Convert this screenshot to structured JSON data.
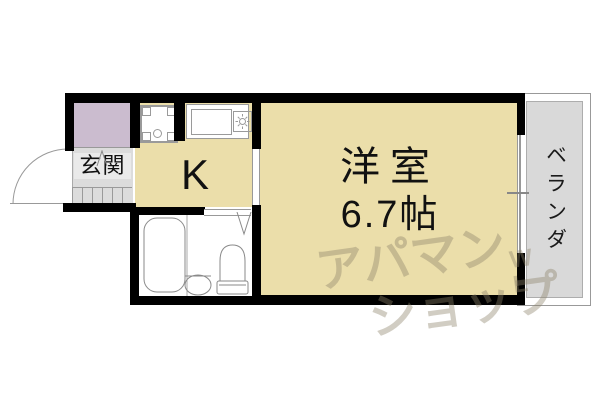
{
  "rooms": {
    "entrance": {
      "label": "玄関"
    },
    "kitchen": {
      "label": "K"
    },
    "main_room": {
      "label": "洋室",
      "size": "6.7帖"
    },
    "balcony": {
      "label": "ベランダ"
    }
  },
  "watermark": {
    "line1": "アパマン",
    "line2": "ショップ",
    "mark": "WL"
  },
  "colors": {
    "floor": "#ebdeaa",
    "closet": "#cbbccf",
    "entrance_floor": "#dcdcdc",
    "balcony": "#d9d9d9",
    "wall": "#000000",
    "fixture_outline": "#999999"
  }
}
